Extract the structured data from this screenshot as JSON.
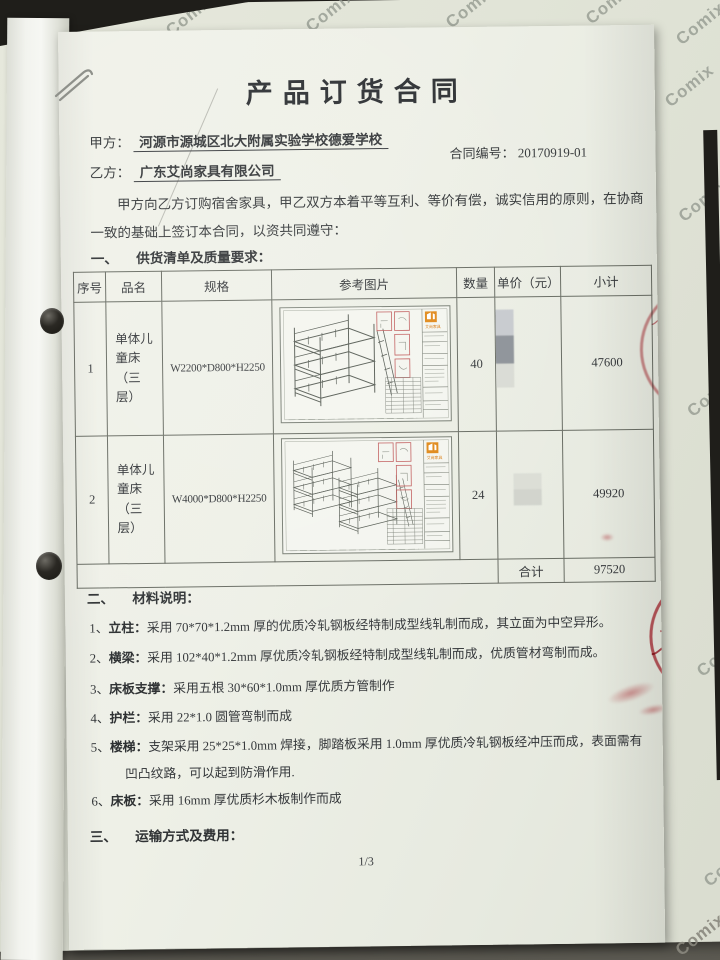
{
  "background": {
    "brand": "Comix"
  },
  "document": {
    "title": "产品订货合同",
    "party_a_label": "甲方：",
    "party_a_name": "河源市源城区北大附属实验学校德爱学校",
    "party_b_label": "乙方：",
    "party_b_name": "广东艾尚家具有限公司",
    "contract_no_label": "合同编号：",
    "contract_no_value": "20170919-01",
    "intro_line1": "甲方向乙方订购宿舍家具，甲乙双方本着平等互利、等价有偿，诚实信用的原则，在协商",
    "intro_line2": "一致的基础上签订本合同，以资共同遵守：",
    "section1_no": "一、",
    "section1_title": "供货清单及质量要求：",
    "section2_no": "二、",
    "section2_title": "材料说明：",
    "section3_no": "三、",
    "section3_title": "运输方式及费用：",
    "page_number": "1/3"
  },
  "table": {
    "headers": {
      "no": "序号",
      "name": "品名",
      "spec": "规格",
      "image": "参考图片",
      "qty": "数量",
      "unit_price": "单价（元）",
      "subtotal": "小计"
    },
    "rows": [
      {
        "no": "1",
        "name": "单体儿童床（三层）",
        "spec": "W2200*D800*H2250",
        "qty": "40",
        "unit_price": "",
        "subtotal": "47600"
      },
      {
        "no": "2",
        "name": "单体儿童床（三层）",
        "spec": "W4000*D800*H2250",
        "qty": "24",
        "unit_price": "",
        "subtotal": "49920"
      }
    ],
    "total_label": "合计",
    "total_value": "97520"
  },
  "materials": {
    "items": [
      {
        "num": "1、",
        "label": "立柱：",
        "text": "采用 70*70*1.2mm 厚的优质冷轧钢板经特制成型线轧制而成，其立面为中空异形。"
      },
      {
        "num": "2、",
        "label": "横梁：",
        "text": "采用 102*40*1.2mm 厚优质冷轧钢板经特制成型线轧制而成，优质管材弯制而成。"
      },
      {
        "num": "3、",
        "label": "床板支撑：",
        "text": "采用五根 30*60*1.0mm 厚优质方管制作"
      },
      {
        "num": "4、",
        "label": "护栏：",
        "text": "采用 22*1.0 圆管弯制而成"
      },
      {
        "num": "5、",
        "label": "楼梯：",
        "text": "支架采用 25*25*1.0mm 焊接，脚踏板采用 1.0mm 厚优质冷轧钢板经冲压而成，表面需有凹凸纹路，可以起到防滑作用."
      },
      {
        "num": "6、",
        "label": "床板：",
        "text": "采用 16mm 厚优质杉木板制作而成"
      }
    ]
  },
  "seal": {
    "chars": [
      "广",
      "东",
      "艾",
      "尚"
    ],
    "bottom_char": "合",
    "color": "#c0454f"
  },
  "drawing": {
    "logo_text": "艾尚家具"
  }
}
